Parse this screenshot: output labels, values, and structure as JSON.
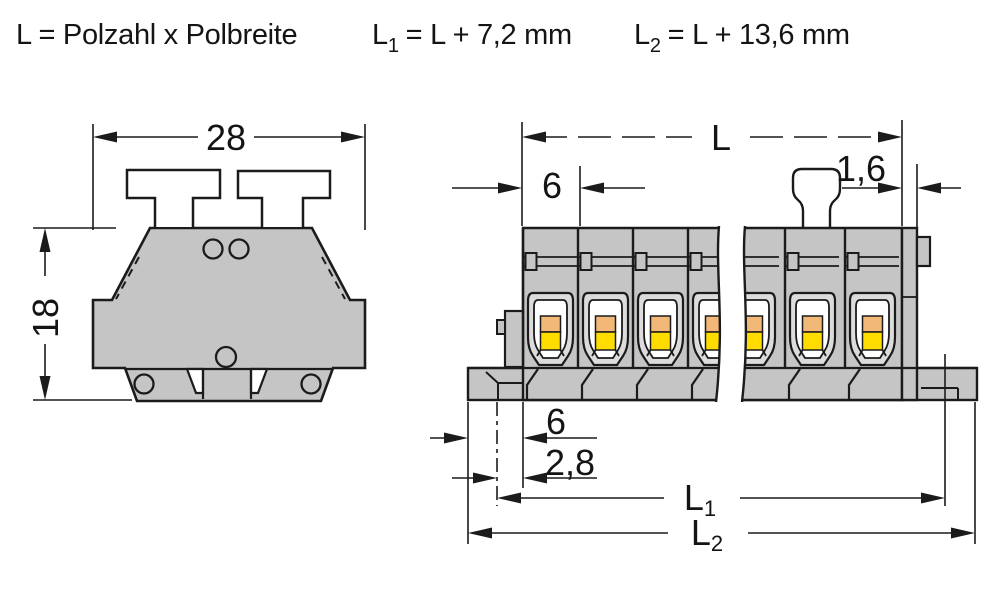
{
  "formulas": {
    "f1": "L = Polzahl x Polbreite",
    "f2_base": "L",
    "f2_sub": "1",
    "f2_rest": "= L + 7,2 mm",
    "f3_base": "L",
    "f3_sub": "2",
    "f3_rest": "= L + 13,6 mm"
  },
  "front_view": {
    "width_label": "28",
    "height_label": "18"
  },
  "strip_view": {
    "length_label": "L",
    "pole_pitch_label": "6",
    "end_wall_label": "1,6",
    "foot_width_label": "6",
    "hole_offset_label": "2,8",
    "l1_base": "L",
    "l1_sub": "1",
    "l2_base": "L",
    "l2_sub": "2"
  },
  "colors": {
    "line": "#1b1b1b",
    "body": "#c5c5c5",
    "frame": "#dcdcdc",
    "orange": "#f2b878",
    "yellow": "#ffdc00"
  }
}
